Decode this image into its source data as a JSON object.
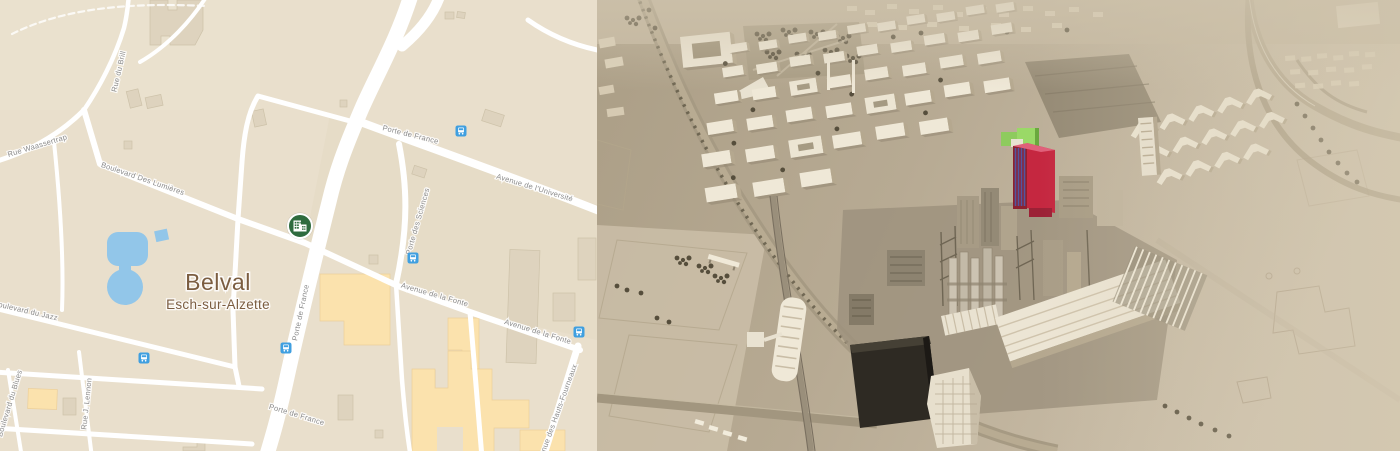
{
  "map": {
    "place": {
      "name": "Belval",
      "region": "Esch-sur-Alzette"
    },
    "streets": {
      "brill": "Rue du Brill",
      "waassertrap": "Rue Waassertrap",
      "lumieres": "Boulevard Des Lumières",
      "jazz": "Boulevard du Jazz",
      "blues": "Boulevard du Blues",
      "lennon": "Rue J. Lennon",
      "porte_de_france": "Porte de France",
      "porte_des_sciences": "Porte des Sciences",
      "universite": "Avenue de l'Université",
      "fonte": "Avenue de la Fonte",
      "hauts_fourneaux": "Avenue des Hauts-Fourneaux"
    },
    "icons": {
      "poi": "office-building-marker-icon",
      "transit": "bus-stop-icon"
    },
    "colors": {
      "land": "#e9dfcc",
      "road": "#ffffff",
      "water": "#92c6e9",
      "building": "#ded3be",
      "building_accent": "#fbe2ad",
      "street_label": "#8a8a8a",
      "place_label": "#7b5d40",
      "marker_green": "#2e6b3e",
      "transit_blue": "#3f9fe0"
    }
  },
  "render": {
    "colors": {
      "ground": "#b7aa93",
      "building": "#efe8d7",
      "highlight_tower": "#c52740",
      "highlight_roof": "#8ecb5e",
      "dark_hall": "#2e2a23",
      "tree": "#564e3c"
    }
  }
}
